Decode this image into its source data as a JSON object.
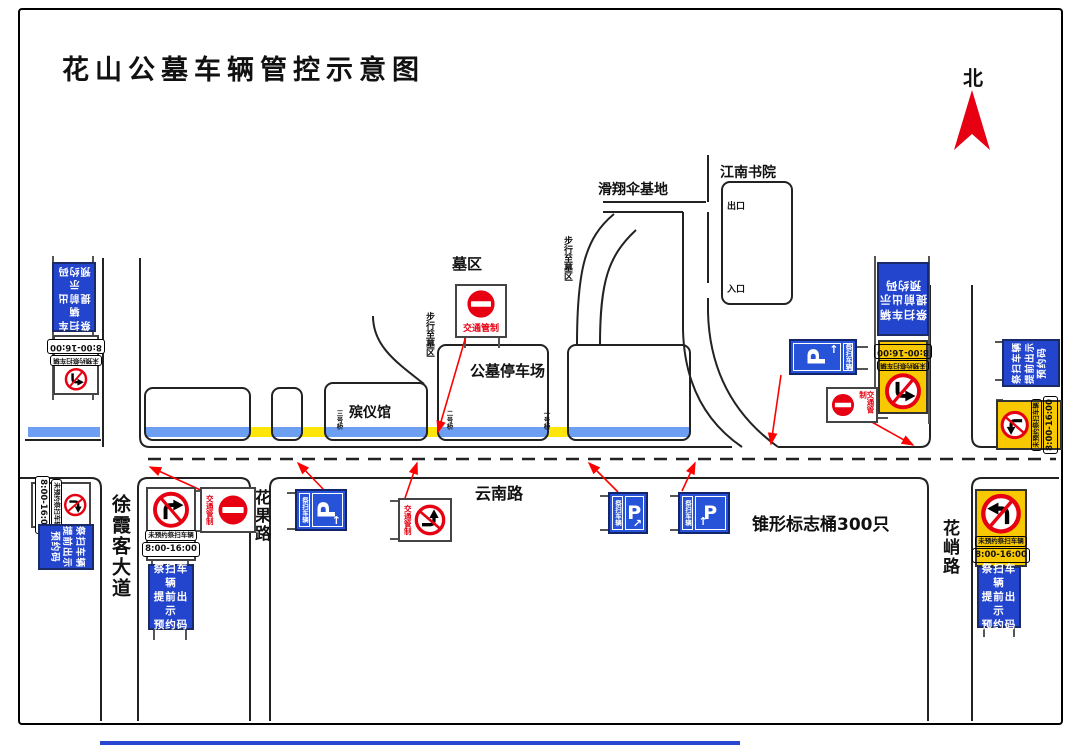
{
  "title": "花山公墓车辆管控示意图",
  "compass": {
    "north": "北"
  },
  "roads": {
    "yunnan": "云南路",
    "xuxiake": "徐霞客大道",
    "huaguo": "花果路",
    "huaqiao": "花峭路"
  },
  "places": {
    "academy": "江南书院",
    "paragliding": "滑翔伞基地",
    "cemetery_area": "墓区",
    "parking_lot": "公墓停车场",
    "funeral_home": "殡仪馆",
    "exit": "出口",
    "entrance": "入口",
    "walk_to_cemetery": "步行至墓区"
  },
  "bridges": {
    "no1": "一号桥",
    "no2": "二号桥",
    "no3": "三号桥"
  },
  "signs": {
    "res": [
      "祭扫车辆",
      "提前出示",
      "预约码"
    ],
    "no_reservation": "未预约祭扫车辆",
    "hours": "8:00-16:00",
    "traffic_control": "交通管制",
    "vehicles": "祭扫车辆",
    "parking_letter": "P",
    "arrow_up": "↑",
    "arrow_upright": "↗"
  },
  "notes": {
    "cones": "锥形标志桶300只"
  },
  "colors": {
    "sign_blue": "#2344cc",
    "panel_blue": "#2753d8",
    "sign_yellow": "#f8c800",
    "ban_red": "#e60012",
    "river_blue": "#6c9ff2",
    "bridge_yellow": "#ffe60a",
    "red_line": "#ff0000"
  }
}
